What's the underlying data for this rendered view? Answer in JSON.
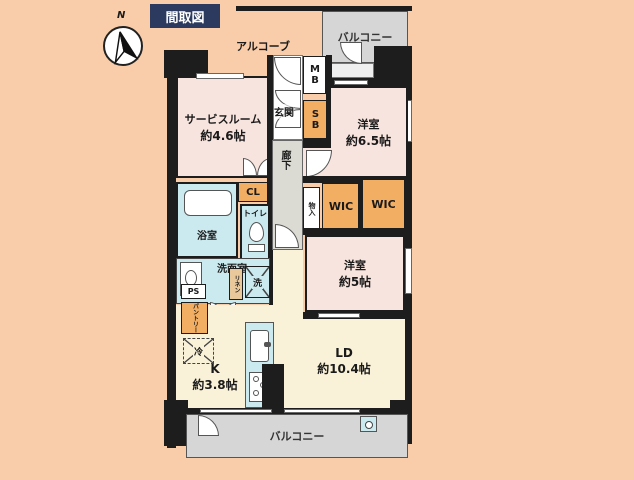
{
  "title": "間取図",
  "compass": {
    "north_label": "N"
  },
  "colors": {
    "background": "#F9CDA9",
    "wall": "#1D1D1D",
    "room_pink": "#F8E4DE",
    "room_cream": "#FAF2D8",
    "room_cyan": "#CBEAEF",
    "storage_orange": "#F2AE63",
    "balcony_gray": "#D6D6D6",
    "title_navy": "#2B3A5E"
  },
  "rooms": {
    "service_room": {
      "name": "サービスルーム",
      "size": "約4.6帖"
    },
    "bedroom_65": {
      "name": "洋室",
      "size": "約6.5帖"
    },
    "bedroom_5": {
      "name": "洋室",
      "size": "約5帖"
    },
    "kitchen": {
      "name": "K",
      "size": "約3.8帖"
    },
    "living_dining": {
      "name": "LD",
      "size": "約10.4帖"
    },
    "balcony_top": "バルコニー",
    "balcony_bottom": "バルコニー",
    "alcove": "アルコーブ",
    "entrance": "玄関",
    "corridor": "廊下",
    "bathroom": "浴室",
    "toilet": "トイレ",
    "washroom": "洗面室"
  },
  "fixtures": {
    "meter_box": "MB",
    "shoe_box": "SB",
    "closet": "CL",
    "pipe_space": "PS",
    "pantry": "パントリー",
    "linen": "リネン",
    "refrigerator": "冷",
    "washer": "洗",
    "storage": "物入",
    "wic_1": "WIC",
    "wic_2": "WIC"
  }
}
